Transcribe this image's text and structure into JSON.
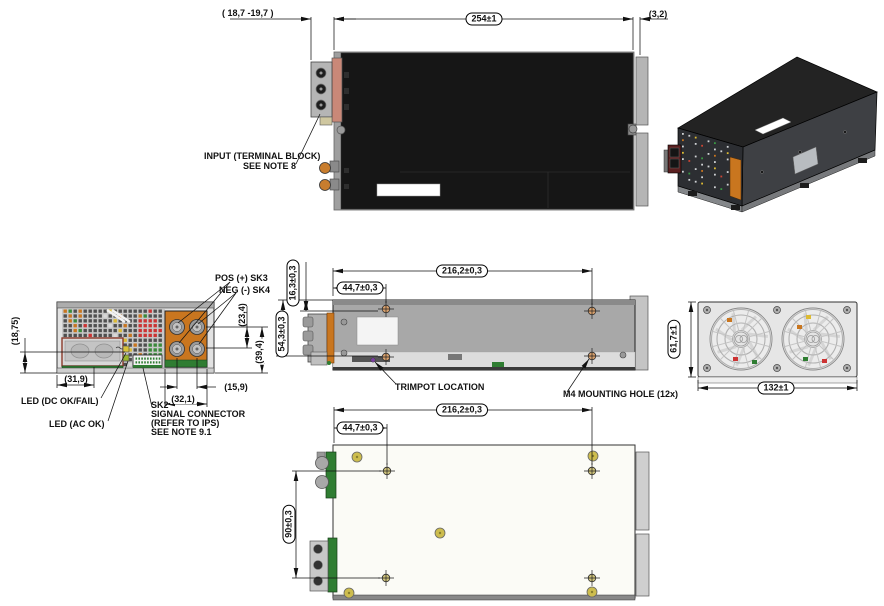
{
  "labels": {
    "input_terminal_line1": "INPUT (TERMINAL BLOCK)",
    "input_terminal_line2": "SEE NOTE 8",
    "pos_sk3": "POS (+) SK3",
    "neg_sk4": "NEG (-) SK4",
    "led_dc": "LED (DC OK/FAIL)",
    "led_ac": "LED (AC OK)",
    "sk2_line1": "SK2",
    "sk2_line2": "SIGNAL CONNECTOR",
    "sk2_line3": "(REFER TO IPS)",
    "sk2_line4": "SEE NOTE 9.1",
    "trimpot": "TRIMPOT LOCATION",
    "m4_hole": "M4 MOUNTING HOLE (12x)"
  },
  "dimensions": {
    "top_view": {
      "terminal_offset": "( 18,7 -19,7 )",
      "body_length": "254±1",
      "rear_offset": "(3,2)"
    },
    "front_view": {
      "led_height": "(18,75)",
      "window_width": "(31,9)",
      "stud_row_pitch": "(23,4)",
      "stud_row_height": "(39,4)",
      "stud_col_pitch": "(15,9)",
      "busbar_width": "(32,1)"
    },
    "side_view": {
      "hole_span": "216,2±0,3",
      "hole_offset_front": "44,7±0,3",
      "hole_offset_top": "16,3±0,3",
      "hole_offset_low": "54,3±0,3"
    },
    "rear_view": {
      "height": "61,7±1",
      "width": "132±1"
    },
    "bottom_view": {
      "hole_span": "216,2±0,3",
      "hole_offset_front": "44,7±0,3",
      "hole_row_pitch": "90±0,3"
    }
  },
  "colors": {
    "chassis_top": "#141414",
    "chassis_gray": "#a8a8a8",
    "busbar_orange": "#c9761f",
    "connector_green": "#2f7d32",
    "led_yellow": "#d8c23a",
    "led_green": "#9ab52e",
    "hole_marker_side": "#d9a06b",
    "hole_marker_bottom": "#cfc37a",
    "trimpot_purple": "#7a3fa0"
  }
}
